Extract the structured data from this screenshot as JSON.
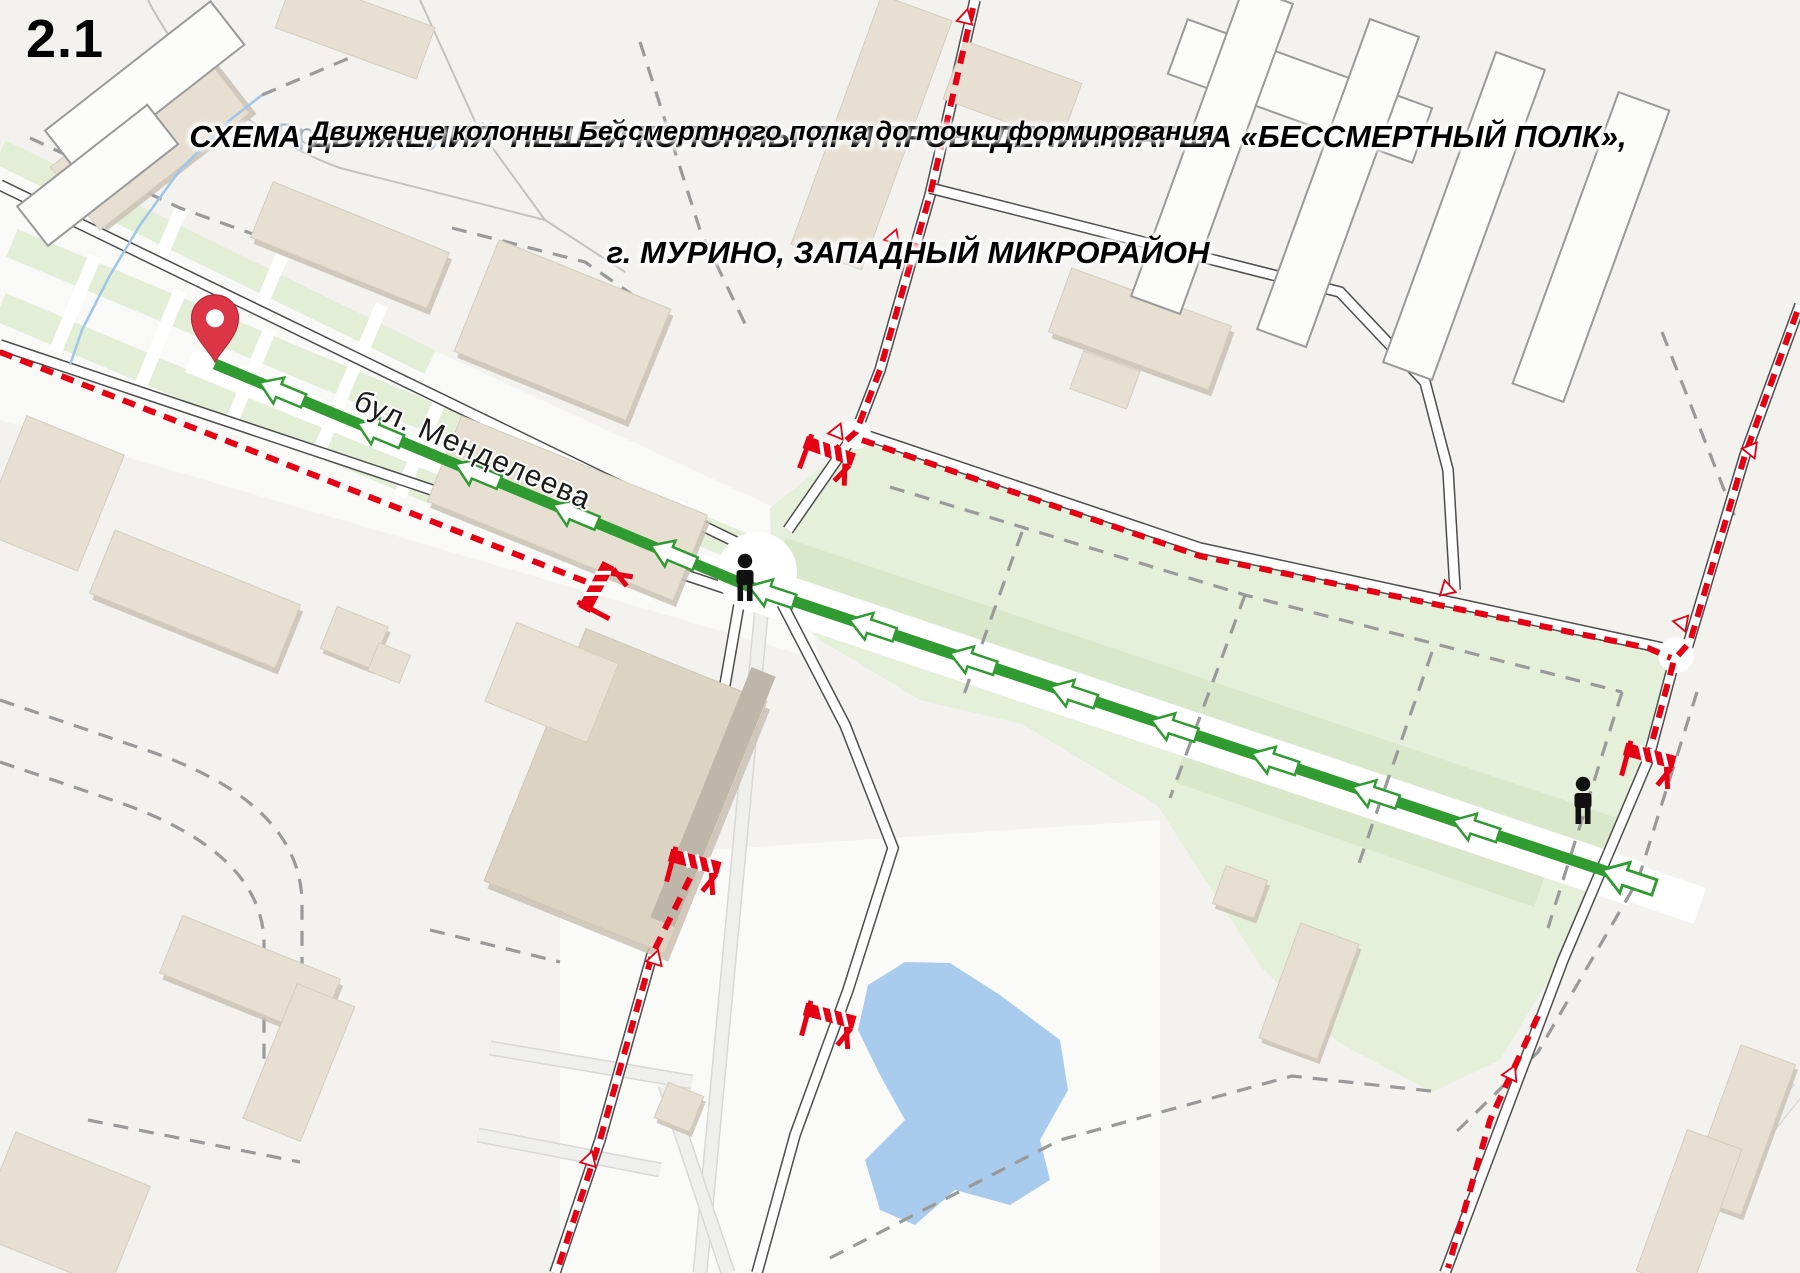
{
  "page": {
    "sheet_number": "2.1"
  },
  "header": {
    "title_line1": "СХЕМА ДВИЖЕНИЯ  ПЕШЕЙ КОЛОННЫ ПРИ ПРОВЕДЕНИИ МАРША «БЕССМЕРТНЫЙ ПОЛК»,",
    "title_line2": "г. МУРИНО, ЗАПАДНЫЙ МИКРОРАЙОН",
    "subtitle": "Движение колонны Бессмертного полка до точки формирования"
  },
  "map": {
    "labels": {
      "street": "бул. Менделеева",
      "stream": "Брачнев ручей"
    },
    "colors": {
      "route_green": "#2f9b30",
      "closure_red": "#e60014",
      "pin_red": "#dc3545",
      "pin_stroke": "#b02a37",
      "pedestrian_black": "#111111",
      "park_green": "#e4f0d9",
      "pond_blue": "#a9cbee",
      "water_label": "#8ba4ba"
    },
    "route": {
      "description": "column walking route, arrows point toward formation point pin",
      "points": [
        [
          215,
          364
        ],
        [
          748,
          586
        ],
        [
          1632,
          880
        ]
      ],
      "width": 11,
      "arrow_first": 72,
      "arrow_step": 106,
      "has_terminal_arrow": true
    },
    "start_pin": {
      "x": 215,
      "y": 362
    },
    "pedestrians": [
      {
        "x": 745,
        "y": 580
      },
      {
        "x": 1583,
        "y": 803
      }
    ],
    "barriers": [
      {
        "x": 827,
        "y": 457,
        "a": 20
      },
      {
        "x": 602,
        "y": 590,
        "a": -62
      },
      {
        "x": 693,
        "y": 868,
        "a": 15
      },
      {
        "x": 828,
        "y": 1022,
        "a": 15
      },
      {
        "x": 1648,
        "y": 762,
        "a": 15
      }
    ],
    "closures": [
      {
        "name": "blvd-south-carriageway",
        "points": [
          [
            0,
            352
          ],
          [
            602,
            588
          ]
        ]
      },
      {
        "name": "north-street",
        "points": [
          [
            973,
            8
          ],
          [
            930,
            195
          ],
          [
            880,
            370
          ],
          [
            856,
            432
          ],
          [
            833,
            452
          ]
        ]
      },
      {
        "name": "park-north-road",
        "points": [
          [
            862,
            440
          ],
          [
            1200,
            556
          ],
          [
            1648,
            648
          ],
          [
            1671,
            658
          ]
        ]
      },
      {
        "name": "east-road-upper",
        "points": [
          [
            1797,
            312
          ],
          [
            1745,
            455
          ],
          [
            1690,
            642
          ],
          [
            1674,
            660
          ],
          [
            1650,
            750
          ]
        ]
      },
      {
        "name": "east-road-lower",
        "points": [
          [
            1538,
            1016
          ],
          [
            1490,
            1120
          ],
          [
            1448,
            1268
          ]
        ]
      },
      {
        "name": "southwest-street",
        "points": [
          [
            690,
            878
          ],
          [
            652,
            955
          ],
          [
            600,
            1140
          ],
          [
            558,
            1268
          ]
        ]
      }
    ],
    "closure_markers": [
      {
        "x": 966,
        "y": 16,
        "a": 103
      },
      {
        "x": 894,
        "y": 236,
        "a": 110
      },
      {
        "x": 838,
        "y": 430,
        "a": 112
      },
      {
        "x": 1449,
        "y": 590,
        "a": 197
      },
      {
        "x": 1752,
        "y": 452,
        "a": 248
      },
      {
        "x": 1683,
        "y": 625,
        "a": 250
      },
      {
        "x": 656,
        "y": 957,
        "a": 107
      },
      {
        "x": 590,
        "y": 1158,
        "a": 107
      },
      {
        "x": 1512,
        "y": 1072,
        "a": 115
      }
    ]
  }
}
